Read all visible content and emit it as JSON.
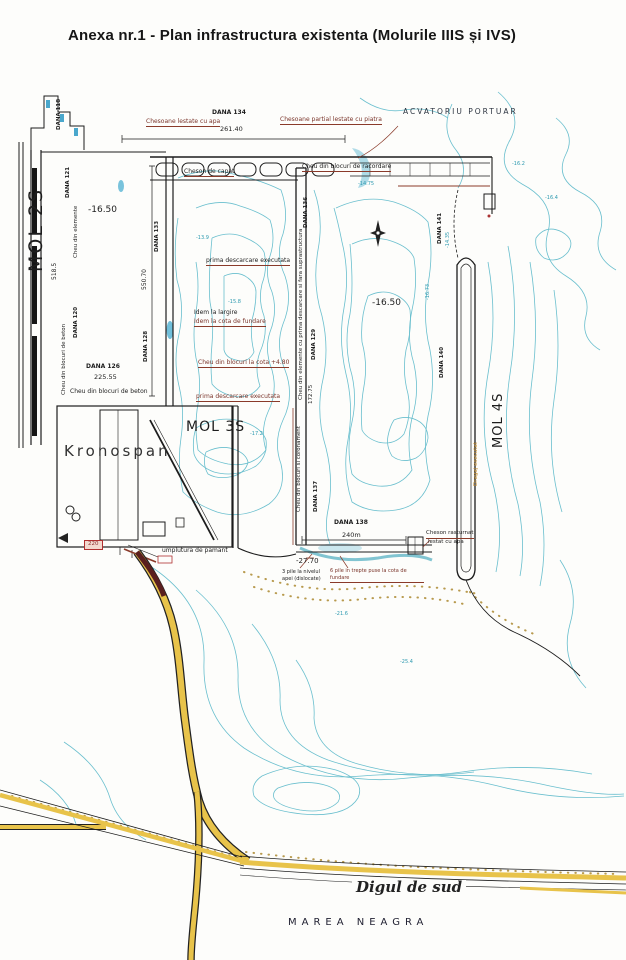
{
  "header": {
    "title": "Anexa nr.1  - Plan infrastructura existenta (Molurile IIIS și IVS)"
  },
  "areas": {
    "acvatoriu_portuar": "ACVATORIU PORTUAR",
    "mol_2s": "MOL 2S",
    "mol_3s": "MOL 3S",
    "mol_4s": "MOL 4S",
    "kronospan": "Kronospan",
    "digul_de_sud": "Digul de sud",
    "marea_neagra": "MAREA NEAGRA"
  },
  "depths": {
    "basin_mol3s": "-16.50",
    "basin_mol4s": "-16.50",
    "south_quay": "-27.70"
  },
  "berths": {
    "dana_118": "DANA 118",
    "dana_121": "DANA 121",
    "dana_120": "DANA 120",
    "dana_126": "DANA 126",
    "dana_133": "DANA 133",
    "dana_128": "DANA 128",
    "dana_134": "DANA 134",
    "dana_136": "DANA 136",
    "dana_129": "DANA 129",
    "dana_137": "DANA 137",
    "dana_138": "DANA 138",
    "dana_140": "DANA 140",
    "dana_141": "DANA 141"
  },
  "dimensions": {
    "north_quay": "261.40",
    "west_outer_quay": "518.5",
    "basin_west_quay": "550.70",
    "dana_126_length": "225.55",
    "south_quay_length": "240m",
    "central_quay": "172.75"
  },
  "annotations": {
    "chesoane_lestate_apa": "Chesoane lestate cu apa",
    "chesoane_partial": "Chesoane partial lestate cu piatra",
    "cheson_capat": "Cheson de capat",
    "cheu_racordare": "Cheu din blocuri de racordare",
    "cheu_elemente": "Cheu din elemente",
    "cheu_blocuri_beton_v": "Cheu din blocuri de beton",
    "cheu_blocuri_beton_h": "Cheu din blocuri de beton",
    "prima_descarcare_1": "prima descarcare executata",
    "idem_largire": "Idem la largire",
    "idem_cota_fundare": "Idem la cota de fundare",
    "cheu_blocuri_cota": "Cheu din blocuri la cota +4.80",
    "prima_descarcare_2": "prima descarcare executata",
    "cheu_elemente_central": "Cheu din elemente cu prima descarcare si fara suprastructura",
    "cheu_blocuri_coronament": "Cheu din blocuri si coronament",
    "umplutura": "umplutura de pamant",
    "pile_nivelul_apei": "3 pile la nivelul apei (dislocate)",
    "pile_trepte": "6 pile in trepte puse la cota de fundare",
    "cheson_rasturnat_1": "Cheson rasturnat",
    "cheson_rasturnat_2": "lestat cu apa",
    "dragaj": "Dragaj executat",
    "box_220": "220"
  },
  "soundings": [
    "-16.2",
    "-14.35",
    "-16.73",
    "-14.75",
    "-15.8",
    "-17.2",
    "-16.4",
    "-21.6",
    "-25.4",
    "-13.9"
  ],
  "colors": {
    "contour": "#6abfce",
    "road_yellow": "#e8c34a",
    "structure": "#1d1d1d",
    "annotation_red": "#8a3a2a"
  }
}
